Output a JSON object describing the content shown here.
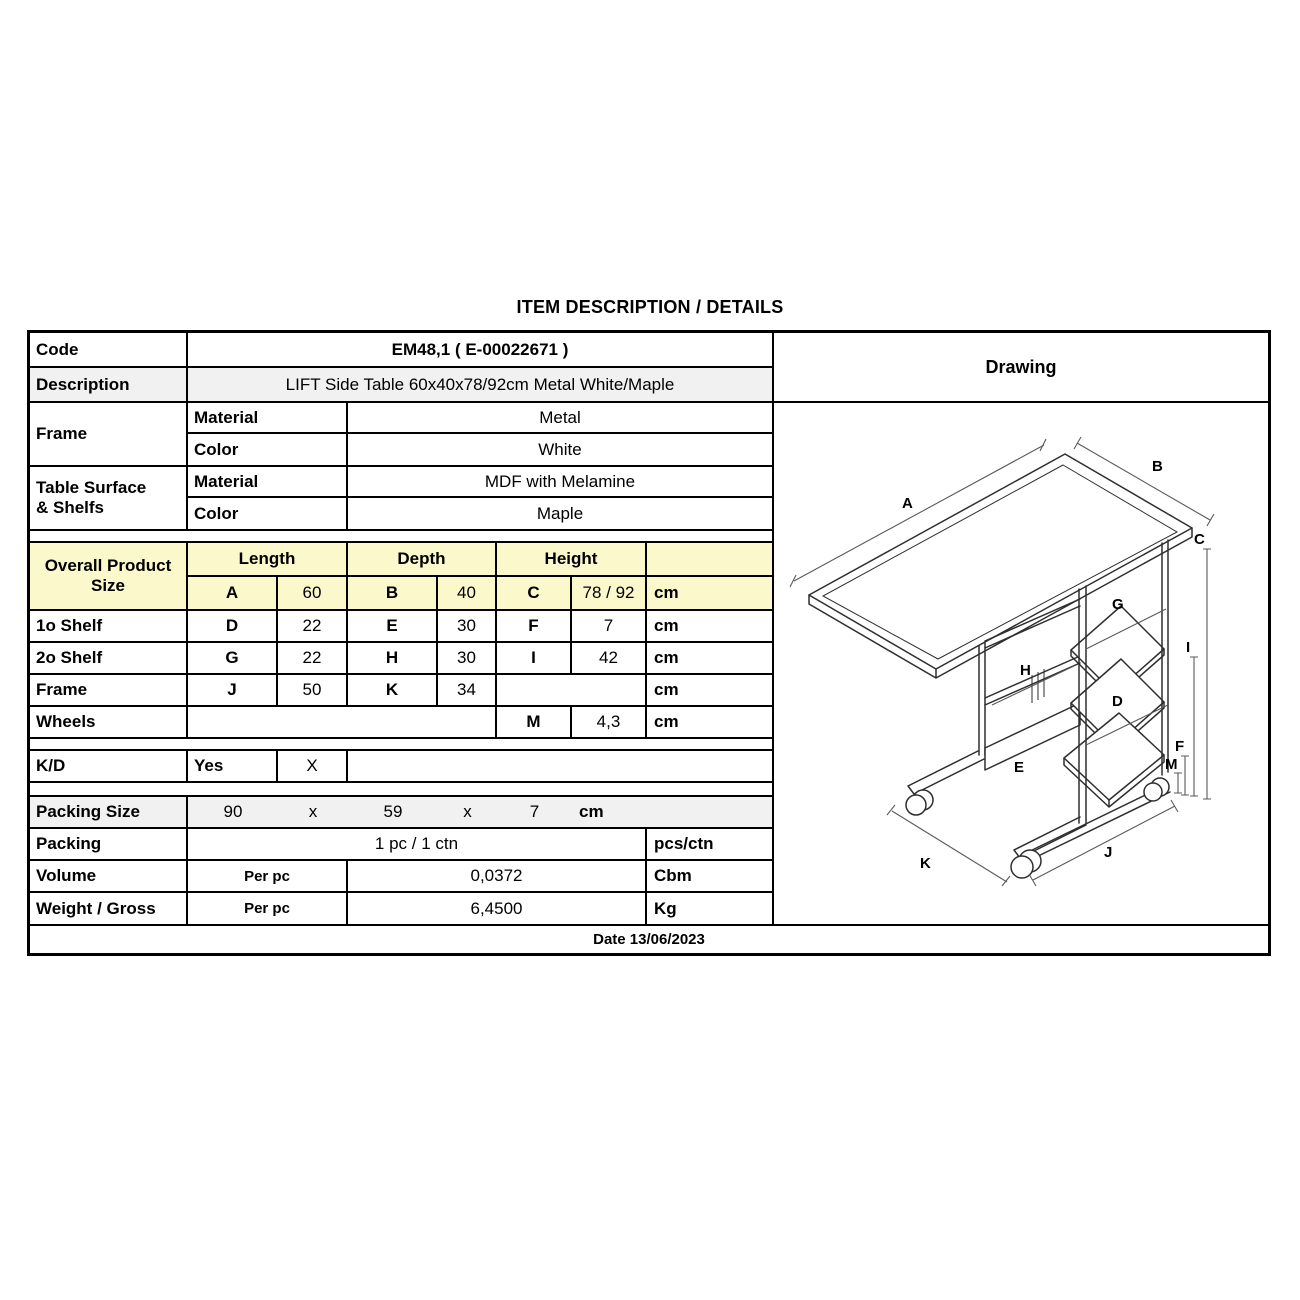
{
  "title": "ITEM DESCRIPTION / DETAILS",
  "colors": {
    "highlight_yellow": "#FBF8CB",
    "row_gray": "#F1F1F1",
    "border": "#000000"
  },
  "table": {
    "code": {
      "label": "Code",
      "value": "EM48,1  ( E-00022671 )"
    },
    "description": {
      "label": "Description",
      "value": "LIFT Side Table 60x40x78/92cm Metal White/Maple"
    },
    "frame": {
      "label": "Frame",
      "material_label": "Material",
      "material": "Metal",
      "color_label": "Color",
      "color": "White"
    },
    "surface": {
      "label_line1": "Table Surface",
      "label_line2": "& Shelfs",
      "material_label": "Material",
      "material": "MDF with Melamine",
      "color_label": "Color",
      "color": "Maple"
    },
    "size": {
      "label_line1": "Overall Product",
      "label_line2": "Size",
      "headers": {
        "length": "Length",
        "depth": "Depth",
        "height": "Height"
      },
      "overall": {
        "l_key": "A",
        "l_val": "60",
        "d_key": "B",
        "d_val": "40",
        "h_key": "C",
        "h_val": "78 / 92",
        "unit": "cm"
      },
      "rows": [
        {
          "label": "1o Shelf",
          "l_key": "D",
          "l_val": "22",
          "d_key": "E",
          "d_val": "30",
          "h_key": "F",
          "h_val": "7",
          "unit": "cm"
        },
        {
          "label": "2o Shelf",
          "l_key": "G",
          "l_val": "22",
          "d_key": "H",
          "d_val": "30",
          "h_key": "I",
          "h_val": "42",
          "unit": "cm"
        },
        {
          "label": "Frame",
          "l_key": "J",
          "l_val": "50",
          "d_key": "K",
          "d_val": "34",
          "h_key": "",
          "h_val": "",
          "unit": "cm"
        }
      ],
      "wheels": {
        "label": "Wheels",
        "h_key": "M",
        "h_val": "4,3",
        "unit": "cm"
      }
    },
    "kd": {
      "label": "K/D",
      "value": "Yes",
      "mark": "X"
    },
    "packing_size": {
      "label": "Packing Size",
      "v1": "90",
      "x1": "x",
      "v2": "59",
      "x2": "x",
      "v3": "7",
      "unit": "cm"
    },
    "packing": {
      "label": "Packing",
      "value": "1 pc / 1 ctn",
      "unit": "pcs/ctn"
    },
    "volume": {
      "label": "Volume",
      "per": "Per pc",
      "value": "0,0372",
      "unit": "Cbm"
    },
    "weight": {
      "label": "Weight / Gross",
      "per": "Per pc",
      "value": "6,4500",
      "unit": "Kg"
    },
    "date": "Date 13/06/2023"
  },
  "drawing": {
    "header": "Drawing",
    "labels": {
      "A": "A",
      "B": "B",
      "C": "C",
      "D": "D",
      "E": "E",
      "F": "F",
      "G": "G",
      "H": "H",
      "I": "I",
      "J": "J",
      "K": "K",
      "M": "M"
    }
  }
}
